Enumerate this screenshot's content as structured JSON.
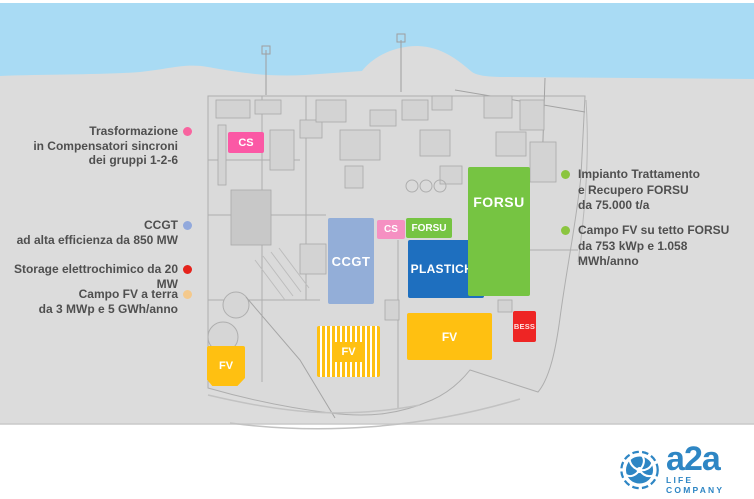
{
  "colors": {
    "sea": "#a9dbf4",
    "land": "#dcdcdc",
    "plan_fill": "#d8d8d8",
    "plan_line": "#aeaeae",
    "cs_main": "#fb58a5",
    "cs_small": "#f590c2",
    "ccgt": "#93aed8",
    "forsu": "#76c442",
    "plastiche": "#1e6fbf",
    "fv": "#ffc011",
    "bess": "#ee2524",
    "annotation_text": "#4f4f4f",
    "logo_blue": "#2e86c4"
  },
  "annotations_left": [
    {
      "text": "Trasformazione\nin Compensatori sincroni\ndei gruppi 1-2-6",
      "dot": "#f8649f"
    },
    {
      "text": "CCGT\nad alta efficienza da 850 MW",
      "dot": "#92a9dc"
    },
    {
      "text": "Storage elettrochimico da 20 MW",
      "dot": "#e5231c"
    },
    {
      "text": "Campo FV a terra\nda 3 MWp e 5 GWh/anno",
      "dot": "#f4c98c"
    }
  ],
  "annotations_right": [
    {
      "text": "Impianto Trattamento\ne Recupero FORSU\nda 75.000 t/a",
      "dot": "#8bc53f"
    },
    {
      "text": "Campo FV su tetto FORSU\nda 753 kWp e 1.058\nMWh/anno",
      "dot": "#8bc53f"
    }
  ],
  "map": {
    "labels": {
      "cs_main": "CS",
      "ccgt": "CCGT",
      "cs_small": "CS",
      "forsu_small": "FORSU",
      "plastiche": "PLASTICHE",
      "forsu_main": "FORSU",
      "fv_left": "FV",
      "fv_striped": "FV",
      "fv_large": "FV",
      "bess": "BESS"
    }
  },
  "logo": {
    "brand": "a2a",
    "tagline": "LIFE COMPANY"
  }
}
